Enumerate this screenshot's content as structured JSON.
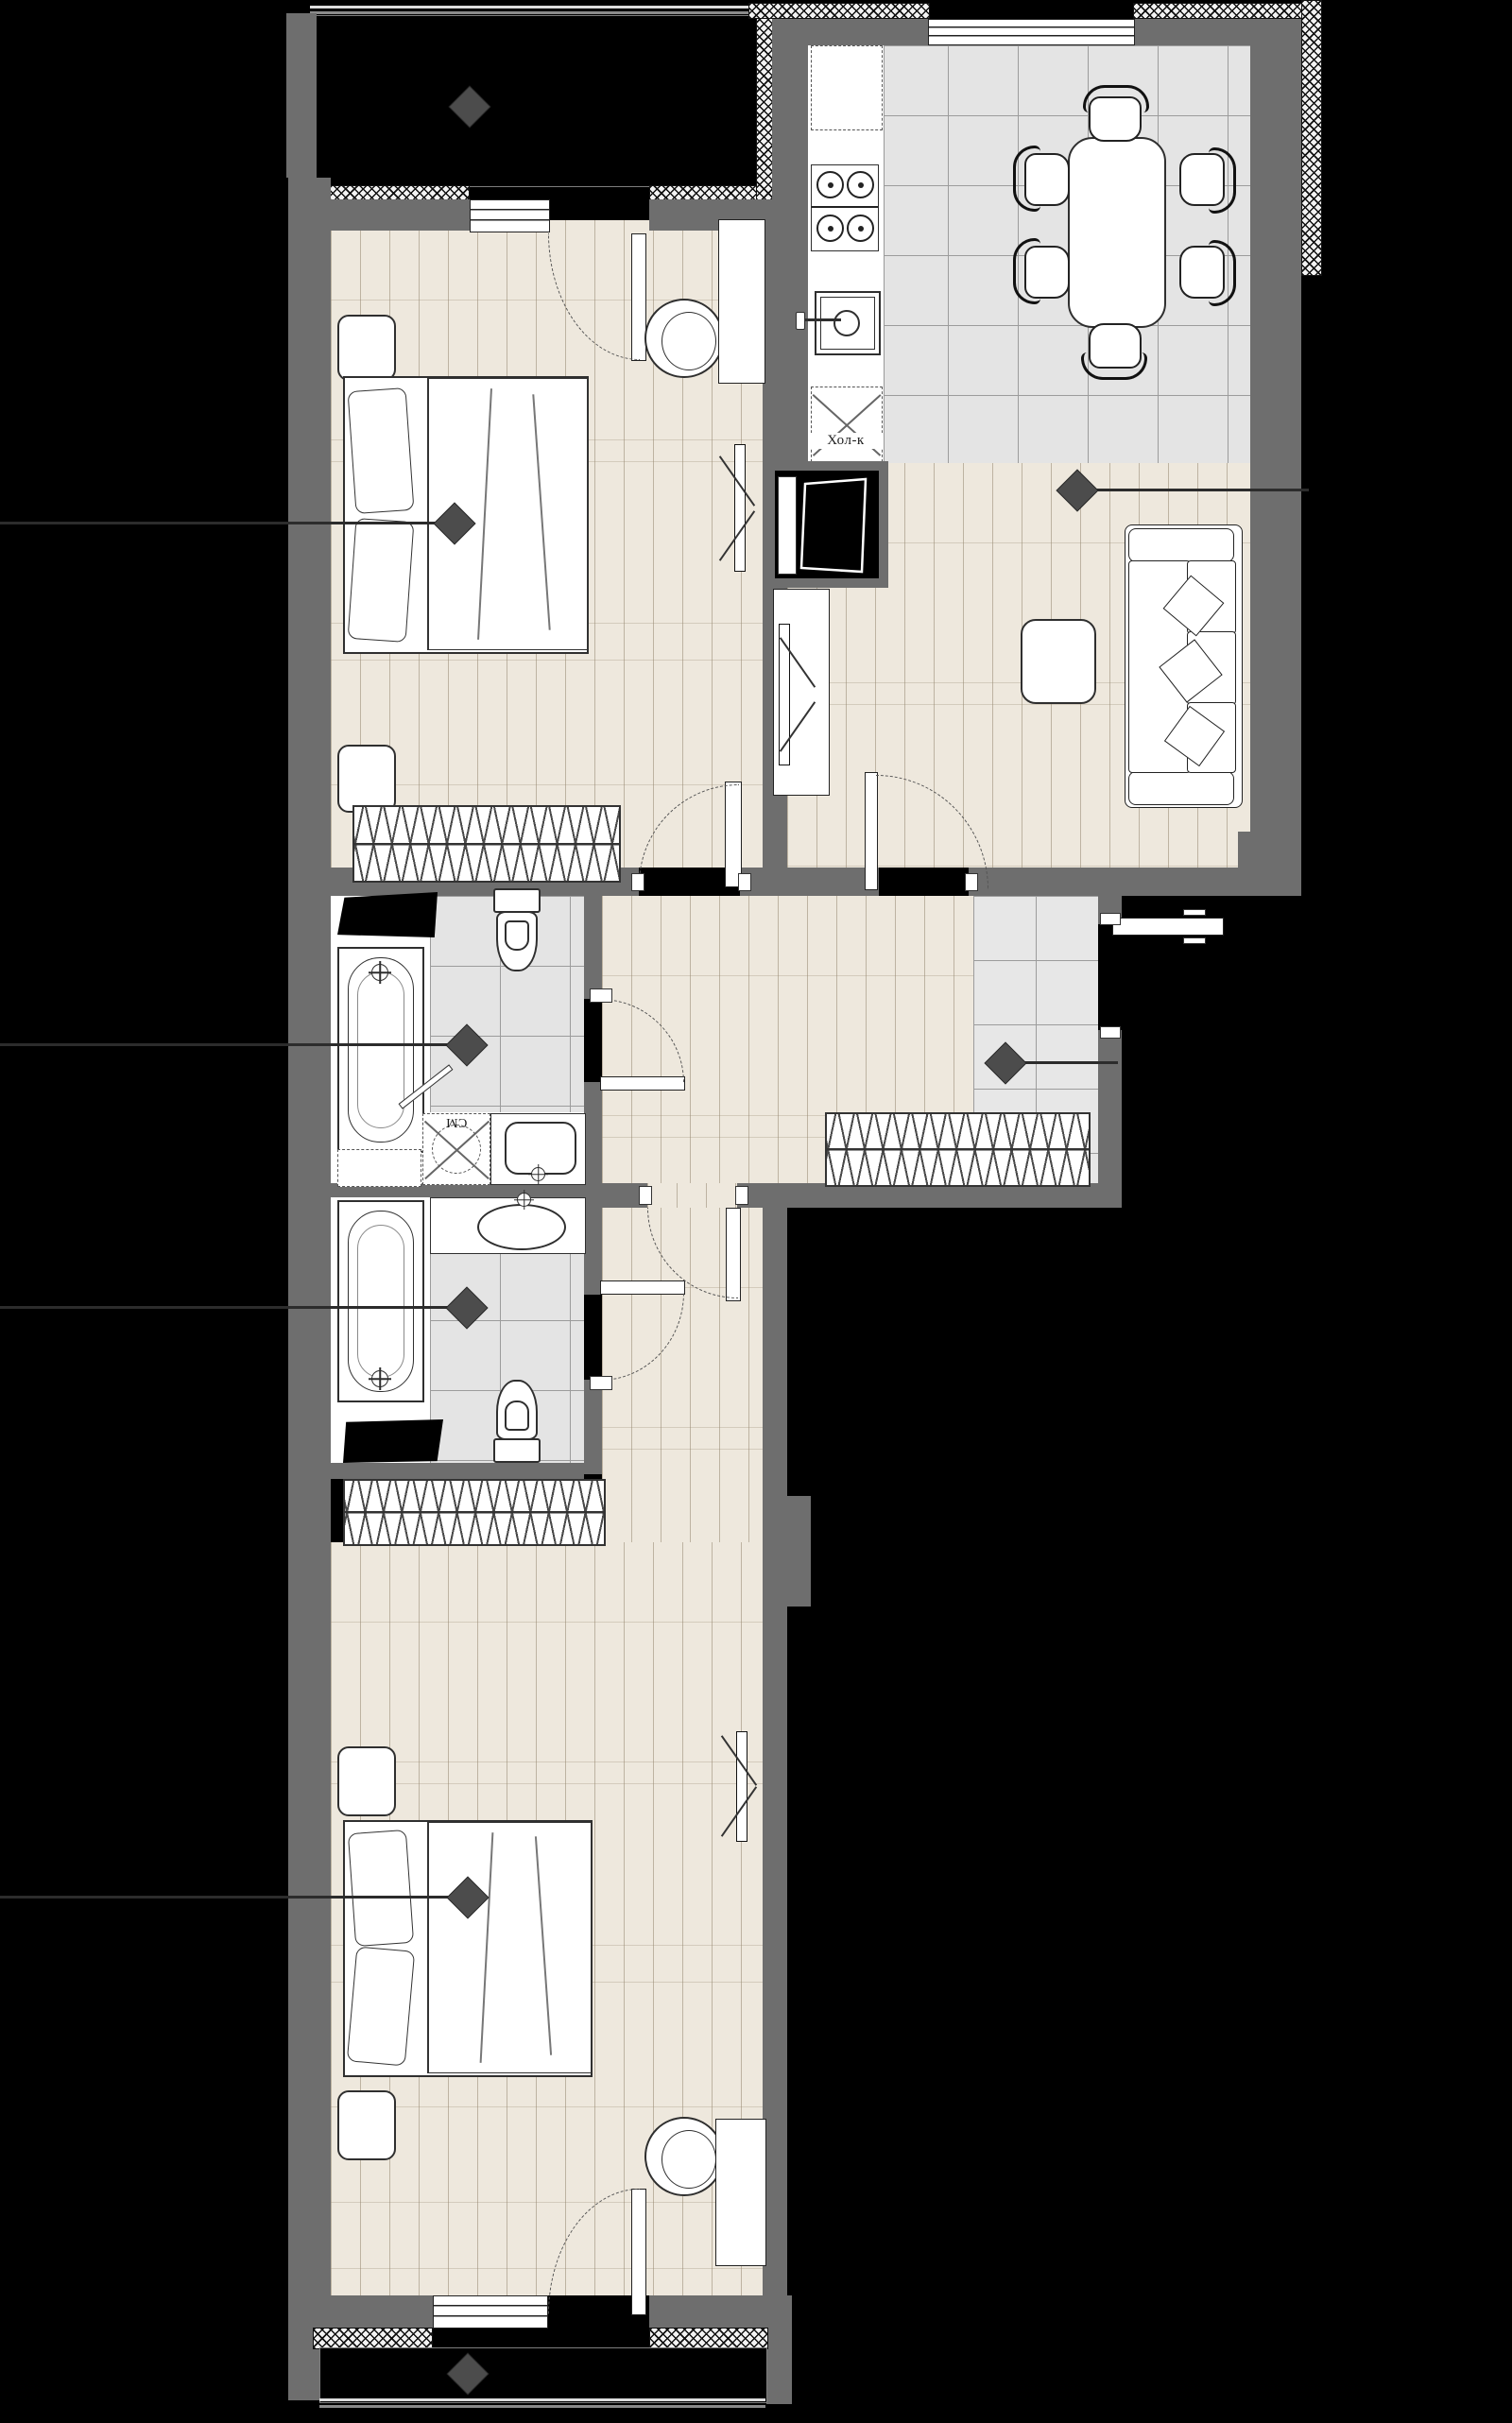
{
  "meta": {
    "type": "apartment-floor-plan",
    "orientation": "vertical",
    "visible_text_language": "ru"
  },
  "colors": {
    "background": "#000000",
    "wall": "#6E6E6E",
    "parquet_floor": "#EEE8DD",
    "tile_floor": "#E4E4E4",
    "entry_tile_floor": "#E7E7E7",
    "marker": "#4C4C4C",
    "fixture_line": "#2F2F2F"
  },
  "labels": {
    "refrigerator": "Хол-к",
    "washing_machine": "СМ"
  },
  "rooms": [
    {
      "id": "balcony-top",
      "floor": "dark",
      "has_marker": true
    },
    {
      "id": "bedroom-top",
      "floor": "parquet",
      "has_marker": true
    },
    {
      "id": "kitchen-dining",
      "floor": "tile",
      "has_marker": false
    },
    {
      "id": "living-room",
      "floor": "parquet",
      "has_marker": true
    },
    {
      "id": "entry-hall",
      "floor": "tile",
      "has_marker": true
    },
    {
      "id": "corridor",
      "floor": "parquet",
      "has_marker": false
    },
    {
      "id": "bathroom-top",
      "floor": "tile",
      "has_marker": true
    },
    {
      "id": "bathroom-bottom",
      "floor": "tile",
      "has_marker": true
    },
    {
      "id": "bedroom-bottom",
      "floor": "parquet",
      "has_marker": true
    },
    {
      "id": "balcony-bottom",
      "floor": "dark",
      "has_marker": true
    }
  ],
  "furniture": {
    "kitchen": [
      "built-in-appliance-dashed",
      "stove-4-burners",
      "kitchen-sink",
      "refrigerator-dashed",
      "dining-table",
      "six-chairs"
    ],
    "living_room": [
      "three-seat-sofa",
      "throw-pillows",
      "coffee-table",
      "tv-cabinet",
      "wall-tv",
      "duct-shaft"
    ],
    "bedroom_top": [
      "double-bed",
      "two-nightstands",
      "wardrobe-with-hangers",
      "armchair",
      "desk",
      "wall-tv"
    ],
    "bedroom_bottom": [
      "double-bed",
      "two-nightstands",
      "wardrobe-with-hangers",
      "armchair",
      "desk",
      "wall-tv"
    ],
    "bathroom_top": [
      "bathtub",
      "toilet",
      "washbasin",
      "washing-machine",
      "bath-mat",
      "towel-rail",
      "dashed-cabinet"
    ],
    "bathroom_bottom": [
      "bathtub",
      "toilet",
      "washbasin-counter",
      "bath-mat"
    ],
    "entry_hall": [
      "coat-rack-with-hangers",
      "entrance-door"
    ]
  },
  "markers_count": 8,
  "doors_count": 9,
  "windows_count": 3
}
